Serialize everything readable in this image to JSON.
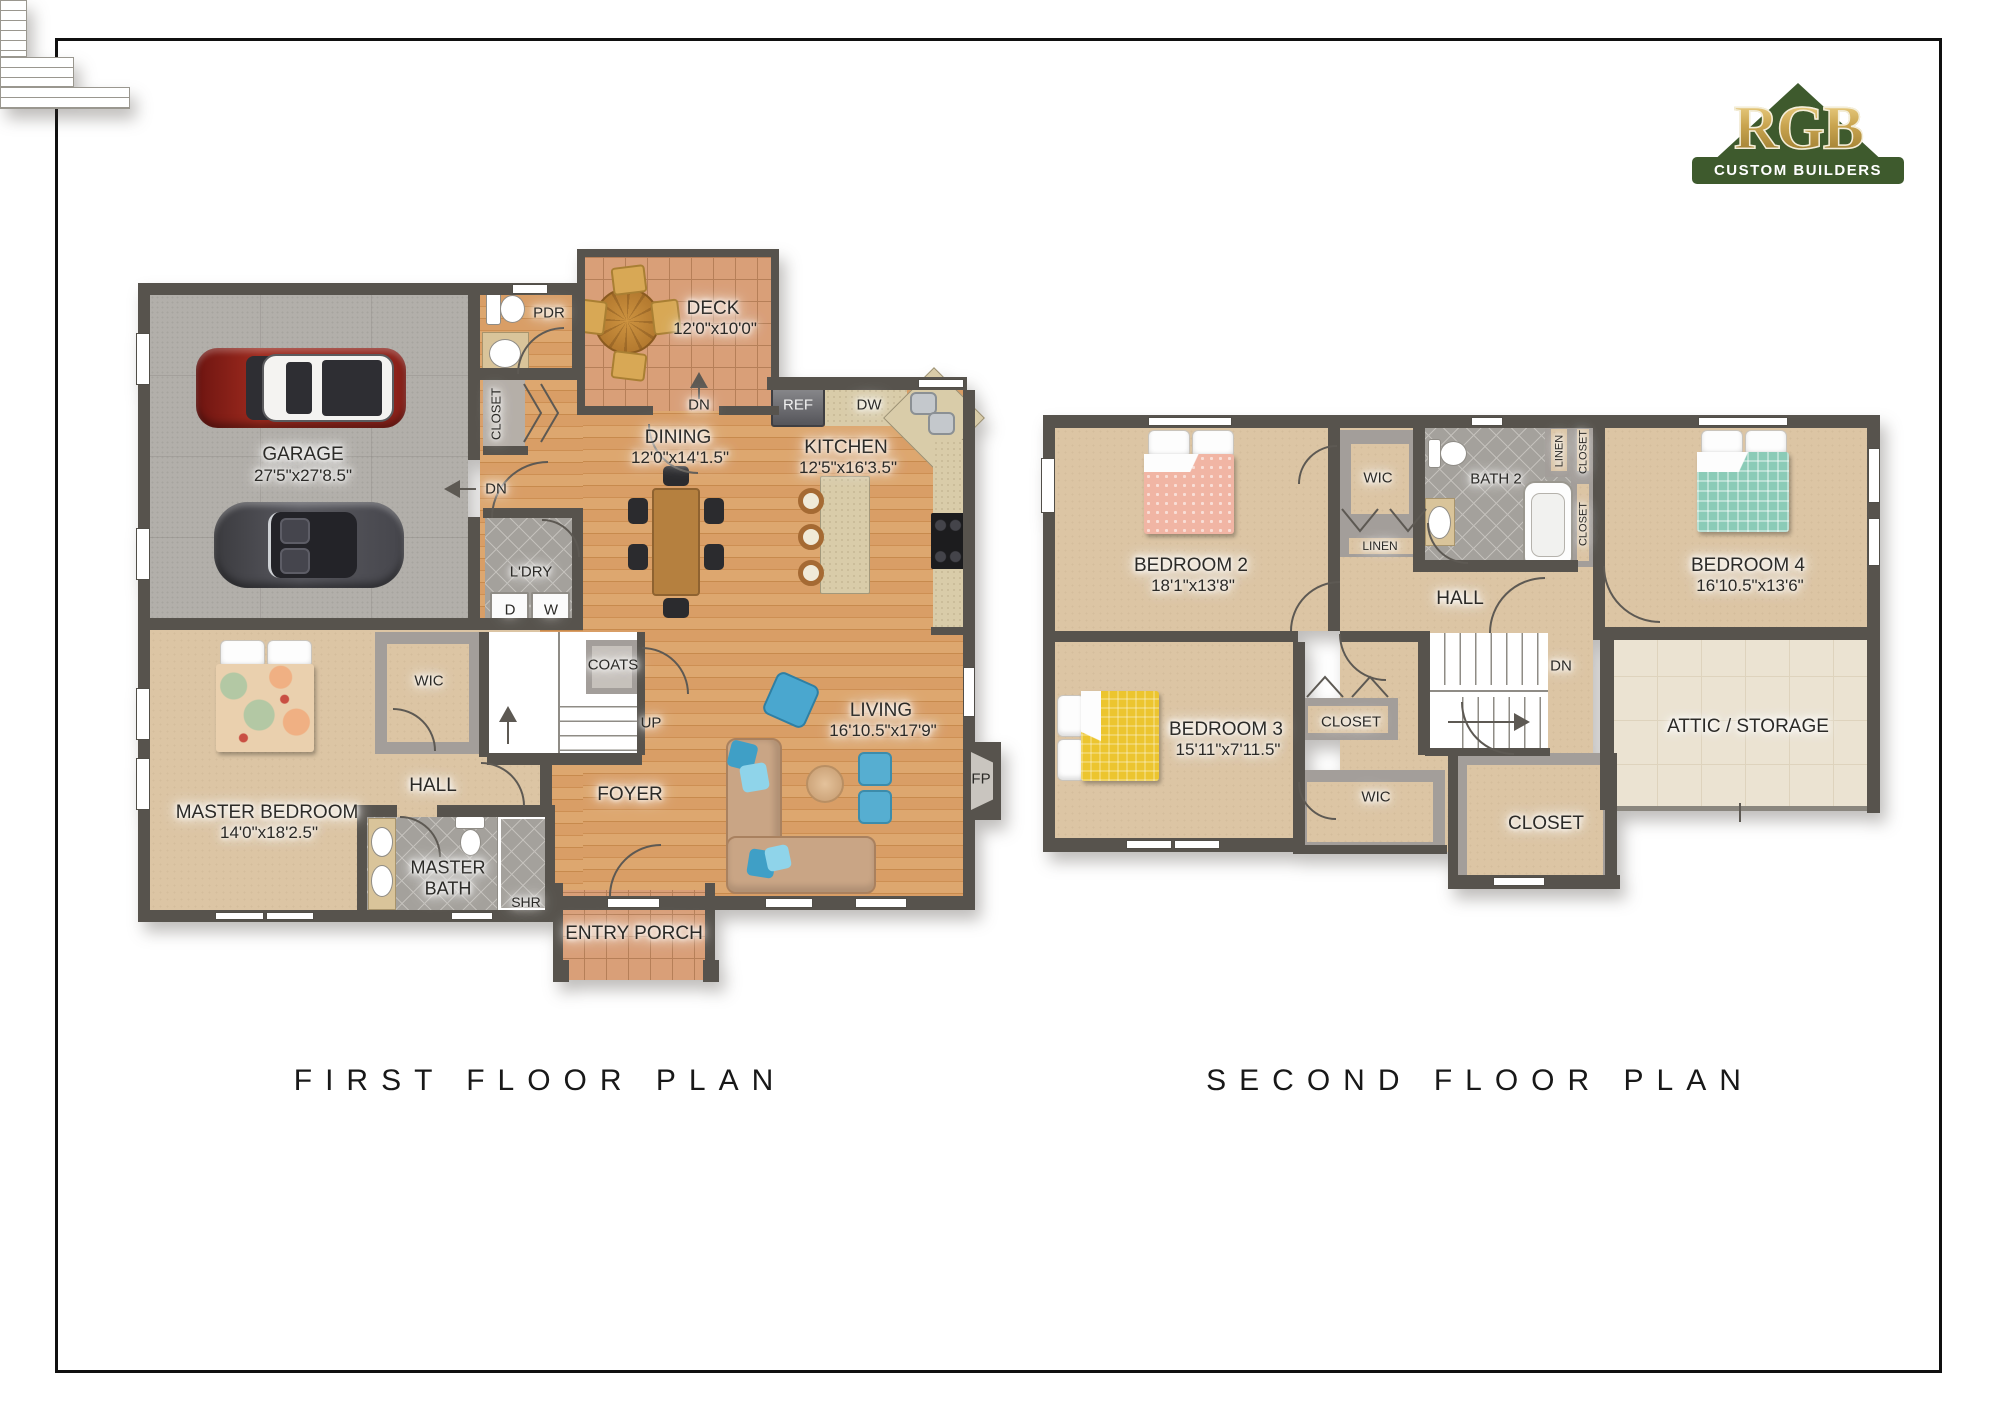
{
  "logo": {
    "brand": "RGB",
    "tagline": "CUSTOM BUILDERS",
    "triangle_color": "#3E5A2D",
    "gold_color": "#C9A44F"
  },
  "first_floor": {
    "title": "FIRST FLOOR PLAN",
    "garage": {
      "name": "GARAGE",
      "dims": "27'5\"x27'8.5\""
    },
    "pdr": {
      "name": "PDR"
    },
    "closet": {
      "name": "CLOSET"
    },
    "laundry": {
      "name": "L'DRY",
      "dryer": "D",
      "washer": "W"
    },
    "deck": {
      "name": "DECK",
      "dims": "12'0\"x10'0\""
    },
    "dining": {
      "name": "DINING",
      "dims": "12'0\"x14'1.5\""
    },
    "kitchen": {
      "name": "KITCHEN",
      "dims": "12'5\"x16'3.5\"",
      "fridge": "REF",
      "dishwasher": "DW"
    },
    "coats": {
      "name": "COATS"
    },
    "foyer": {
      "name": "FOYER"
    },
    "living": {
      "name": "LIVING",
      "dims": "16'10.5\"x17'9\"",
      "fireplace": "FP"
    },
    "master_bedroom": {
      "name": "MASTER BEDROOM",
      "dims": "14'0\"x18'2.5\""
    },
    "wic": {
      "name": "WIC"
    },
    "hall": {
      "name": "HALL"
    },
    "master_bath": {
      "name": "MASTER BATH",
      "shower": "SHR"
    },
    "entry_porch": {
      "name": "ENTRY PORCH"
    },
    "stairs": {
      "up": "UP",
      "down_to_garage": "DN",
      "down_to_yard": "DN"
    }
  },
  "second_floor": {
    "title": "SECOND FLOOR PLAN",
    "bedroom2": {
      "name": "BEDROOM 2",
      "dims": "18'1\"x13'8\""
    },
    "bedroom3": {
      "name": "BEDROOM 3",
      "dims": "15'11\"x7'11.5\""
    },
    "bedroom4": {
      "name": "BEDROOM 4",
      "dims": "16'10.5\"x13'6\""
    },
    "wic_bedroom2": {
      "name": "WIC"
    },
    "linen_hall": {
      "name": "LINEN"
    },
    "bath2": {
      "name": "BATH 2"
    },
    "linen_bath": {
      "name": "LINEN"
    },
    "closet_bath_upper": {
      "name": "CLOSET"
    },
    "closet_bath_lower": {
      "name": "CLOSET"
    },
    "hall": {
      "name": "HALL"
    },
    "closet_bedroom3": {
      "name": "CLOSET"
    },
    "wic_bedroom3": {
      "name": "WIC"
    },
    "closet_hall": {
      "name": "CLOSET"
    },
    "attic": {
      "name": "ATTIC / STORAGE"
    },
    "stairs": {
      "down": "DN"
    }
  }
}
